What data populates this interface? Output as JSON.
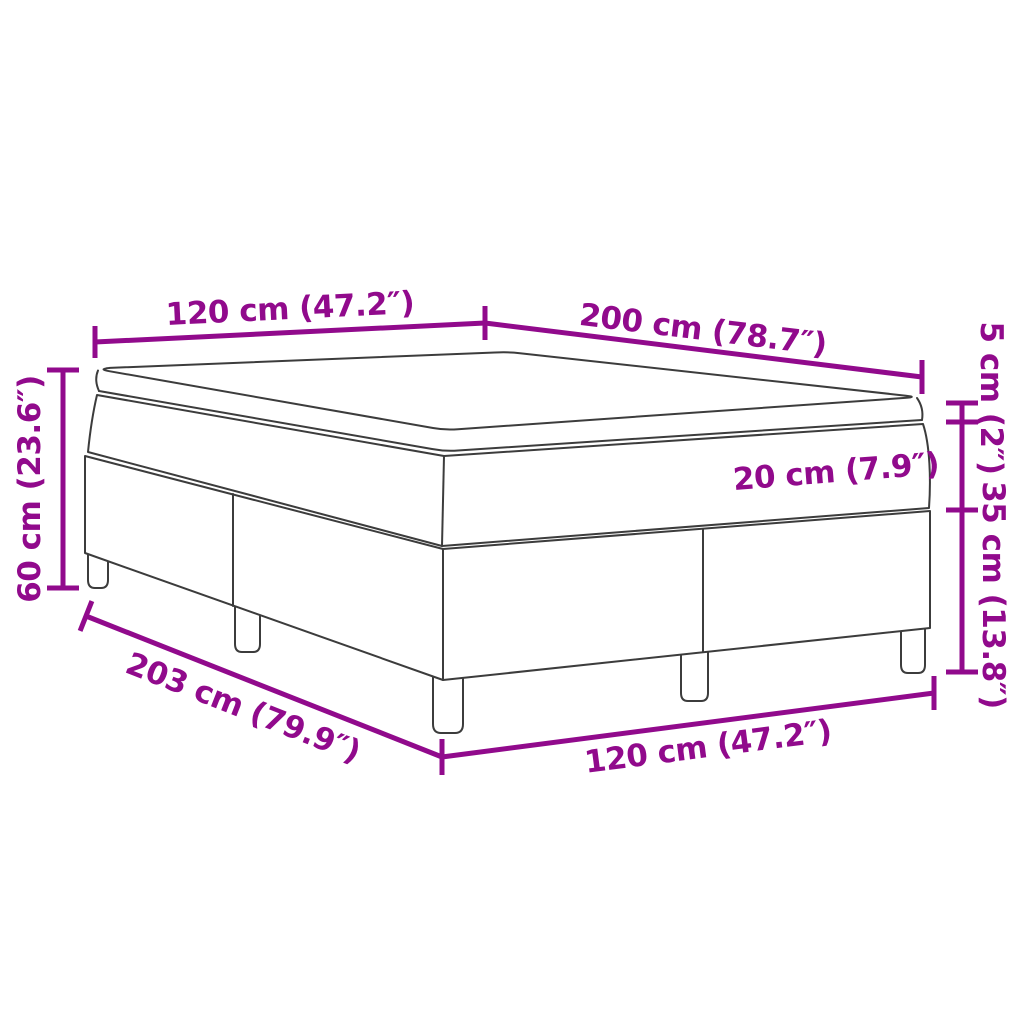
{
  "diagram": {
    "title": "Box spring bed with mattress dimension diagram",
    "colors": {
      "dimension_accent": "#910a8c",
      "outline": "#3c3c3c",
      "background": "#ffffff"
    },
    "labels": {
      "top_width": "120 cm (47.2″)",
      "top_length": "200 cm (78.7″)",
      "topper_height": "5 cm (2″)",
      "mattress_height": "20 cm (7.9″)",
      "base_height": "35 cm (13.8″)",
      "total_height": "60 cm (23.6″)",
      "base_length": "203 cm (79.9″)",
      "base_width": "120 cm (47.2″)"
    }
  }
}
